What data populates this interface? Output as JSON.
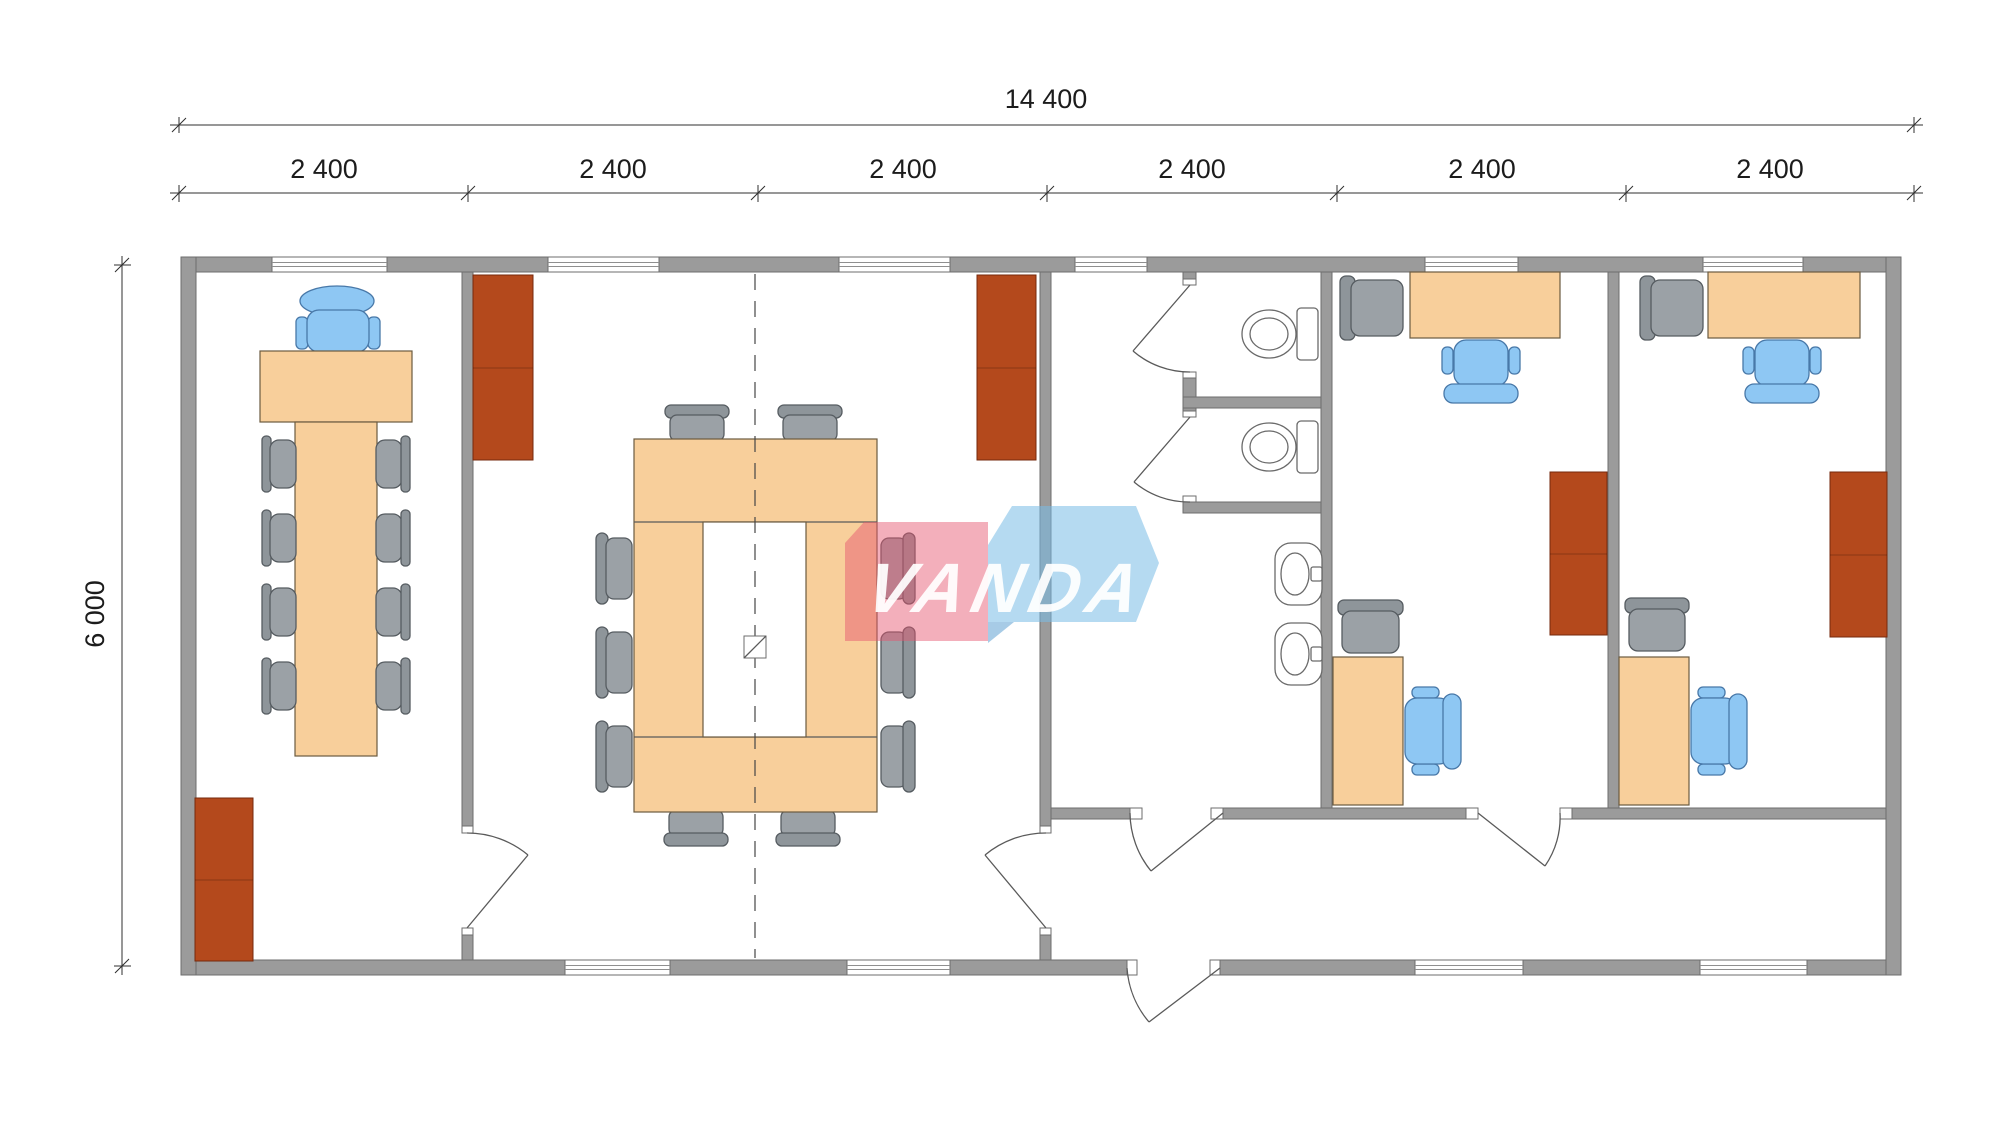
{
  "dimensions": {
    "overall_width_label": "14 400",
    "overall_height_label": "6 000",
    "module_labels": [
      "2 400",
      "2 400",
      "2 400",
      "2 400",
      "2 400",
      "2 400"
    ]
  },
  "watermark": {
    "text": "VANDA"
  },
  "colors": {
    "wall_fill": "#9b9b9b",
    "wall_outline": "#6e6e6e",
    "furniture_wood": "#f8cf9b",
    "cabinet_brown": "#b4491c",
    "chair_gray": "#9ba1a6",
    "chair_blue": "#8ec7f3",
    "watermark_pink": "#ef5d78",
    "watermark_blue": "#78bce6",
    "fixture_white": "#ffffff"
  },
  "plan": {
    "building_modules": 6,
    "rooms": [
      {
        "name": "meeting-room",
        "contents": [
          "t-shaped-table",
          "executive-chair",
          "8-side-chairs",
          "cabinet"
        ]
      },
      {
        "name": "conference-room",
        "contents": [
          "ring-conference-table",
          "10-chairs",
          "2-cabinets",
          "module-joint-centerline"
        ]
      },
      {
        "name": "sanitary-block",
        "contents": [
          "2-wc-stalls",
          "2-toilets",
          "2-washbasins"
        ]
      },
      {
        "name": "entrance-hall-corridor",
        "contents": [
          "entrance-door"
        ]
      },
      {
        "name": "office-1",
        "contents": [
          "2-desks",
          "2-task-chairs",
          "2-visitor-chairs",
          "cabinet"
        ]
      },
      {
        "name": "office-2",
        "contents": [
          "2-desks",
          "2-task-chairs",
          "2-visitor-chairs",
          "cabinet"
        ]
      }
    ]
  }
}
